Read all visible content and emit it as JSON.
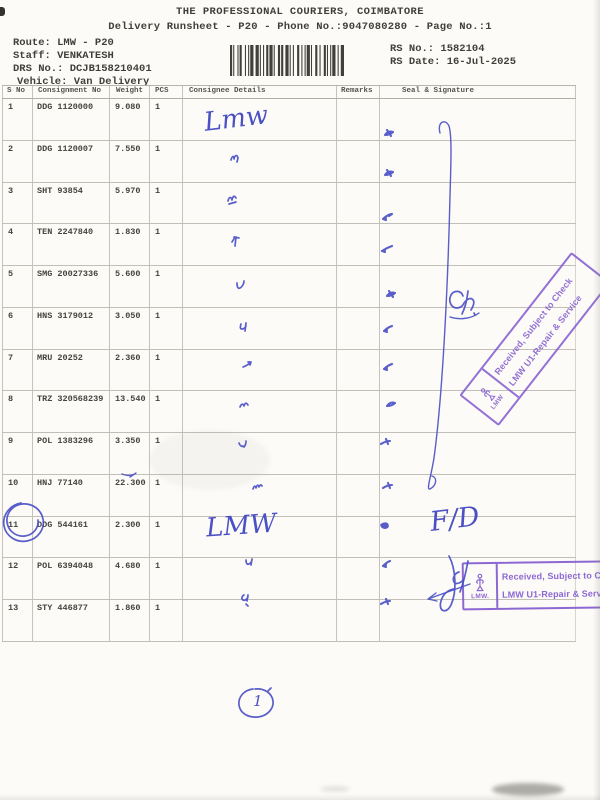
{
  "header": {
    "title": "THE PROFESSIONAL COURIERS, COIMBATORE",
    "subtitle": "Delivery Runsheet - P20 - Phone No.:9047080280 - Page No.:1",
    "route": "Route: LMW - P20",
    "staff": "Staff: VENKATESH",
    "drs_no": "DRS No.: DCJB158210401",
    "vehicle": "Vehicle: Van Delivery",
    "rs_no": "RS No.: 1582104",
    "rs_date": "RS Date: 16-Jul-2025"
  },
  "table": {
    "headers": [
      "S No",
      "Consignment No",
      "Weight",
      "PCS",
      "Consignee Details",
      "Remarks",
      "Seal & Signature"
    ],
    "rows": [
      {
        "s_no": "1",
        "consignment": "DDG 1120000",
        "weight": "9.080",
        "pcs": "1"
      },
      {
        "s_no": "2",
        "consignment": "DDG 1120007",
        "weight": "7.550",
        "pcs": "1"
      },
      {
        "s_no": "3",
        "consignment": "SHT 93854",
        "weight": "5.970",
        "pcs": "1"
      },
      {
        "s_no": "4",
        "consignment": "TEN 2247840",
        "weight": "1.830",
        "pcs": "1"
      },
      {
        "s_no": "5",
        "consignment": "SMG 20027336",
        "weight": "5.600",
        "pcs": "1"
      },
      {
        "s_no": "6",
        "consignment": "HNS 3179012",
        "weight": "3.050",
        "pcs": "1"
      },
      {
        "s_no": "7",
        "consignment": "MRU 20252",
        "weight": "2.360",
        "pcs": "1"
      },
      {
        "s_no": "8",
        "consignment": "TRZ 320568239",
        "weight": "13.540",
        "pcs": "1"
      },
      {
        "s_no": "9",
        "consignment": "POL 1383296",
        "weight": "3.350",
        "pcs": "1"
      },
      {
        "s_no": "10",
        "consignment": "HNJ 77140",
        "weight": "22.300",
        "pcs": "1"
      },
      {
        "s_no": "11",
        "consignment": "DDG 544161",
        "weight": "2.300",
        "pcs": "1"
      },
      {
        "s_no": "12",
        "consignment": "POL 6394048",
        "weight": "4.680",
        "pcs": "1"
      },
      {
        "s_no": "13",
        "consignment": "STY 446877",
        "weight": "1.860",
        "pcs": "1"
      }
    ]
  },
  "handwriting": {
    "row1_note": "Lmw",
    "row11_note": "LMW",
    "fd_note": "F/D",
    "circled_note": "1"
  },
  "stamps": {
    "received_line1": "Received, Subject to Check",
    "received_line2": "LMW U1-Repair & Service",
    "org_diagonal": "LMW",
    "org_bottom": "LMW."
  },
  "colors": {
    "ink_blue": "#4b50c5",
    "stamp_purple": "#8159cf",
    "print_gray": "#413f3a"
  }
}
